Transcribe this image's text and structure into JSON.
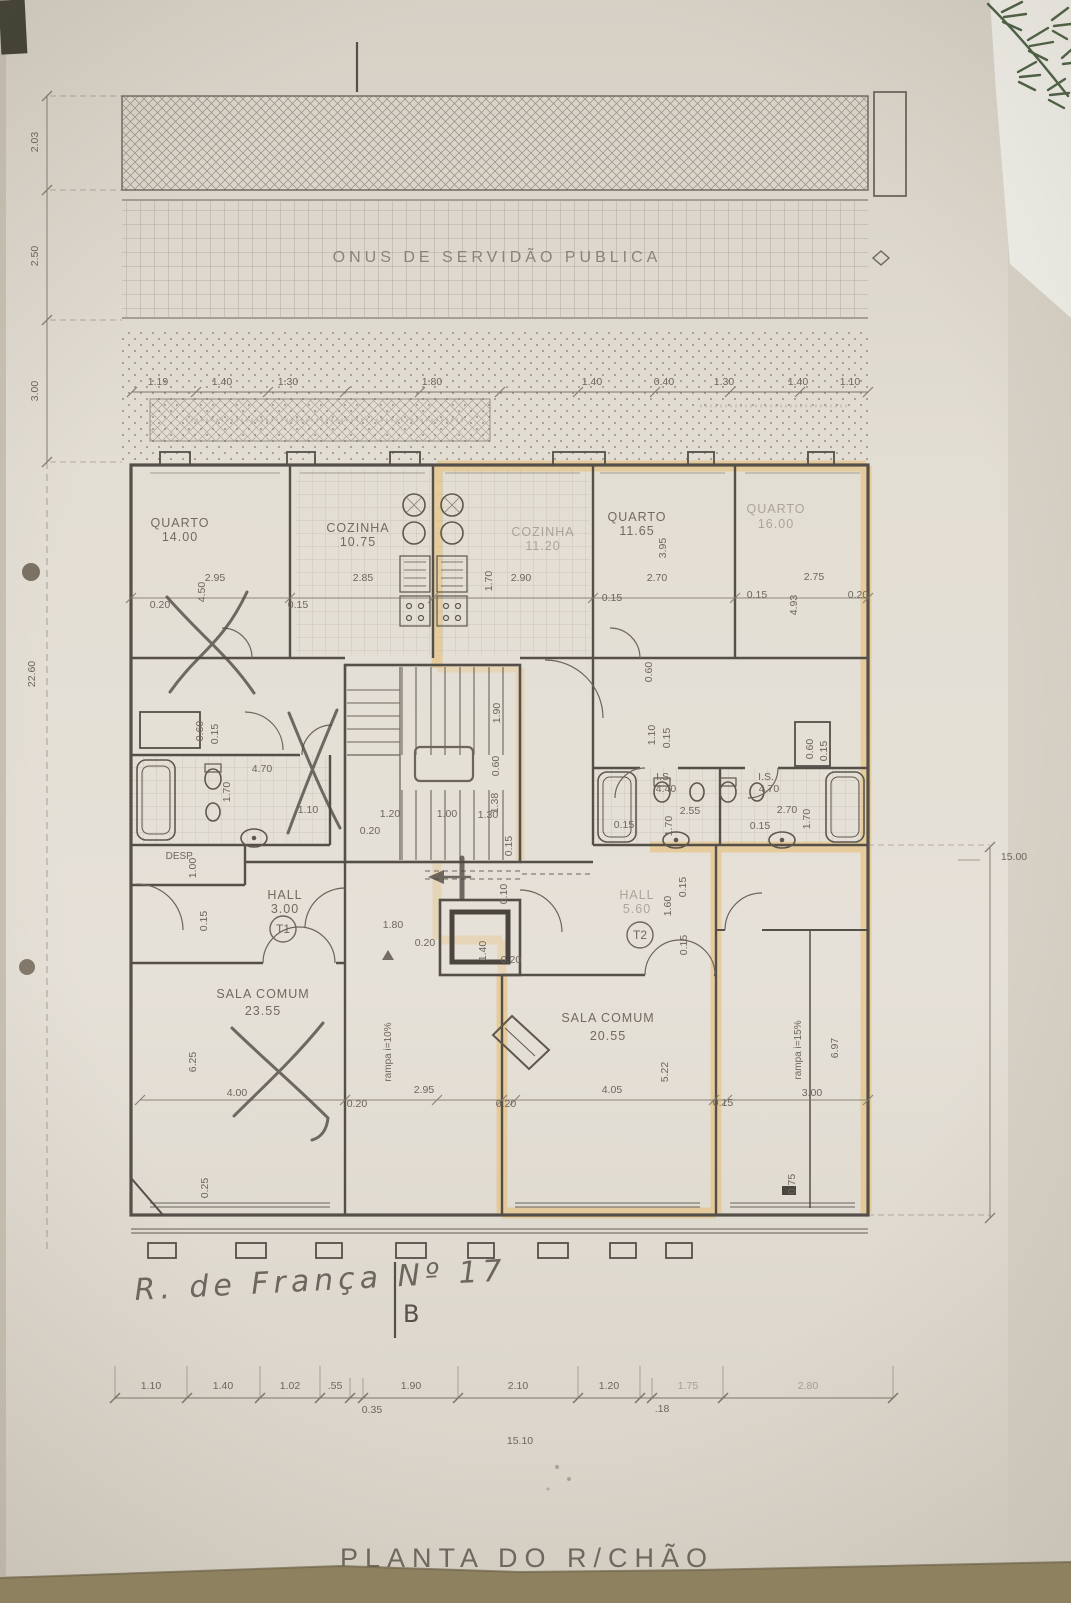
{
  "title": "PLANTA DO R/CHÃO",
  "servitude_label": "ONUS DE SERVIDÃO PUBLICA",
  "street_note": "R. de França Nº 17",
  "section_marker": "B",
  "unit_markers": {
    "t1": "T1",
    "t2": "T2"
  },
  "labels": [
    {
      "t": "QUARTO",
      "x": 180,
      "y": 527,
      "c": "room"
    },
    {
      "t": "14.00",
      "x": 180,
      "y": 541,
      "c": "room"
    },
    {
      "t": "COZINHA",
      "x": 358,
      "y": 532,
      "c": "room"
    },
    {
      "t": "10.75",
      "x": 358,
      "y": 546,
      "c": "room"
    },
    {
      "t": "COZINHA",
      "x": 543,
      "y": 536,
      "c": "room faintr"
    },
    {
      "t": "11.20",
      "x": 543,
      "y": 550,
      "c": "room faintr"
    },
    {
      "t": "QUARTO",
      "x": 637,
      "y": 521,
      "c": "room"
    },
    {
      "t": "11.65",
      "x": 637,
      "y": 535,
      "c": "room"
    },
    {
      "t": "QUARTO",
      "x": 776,
      "y": 513,
      "c": "room faintr"
    },
    {
      "t": "16.00",
      "x": 776,
      "y": 528,
      "c": "room faintr"
    },
    {
      "t": "SALA COMUM",
      "x": 263,
      "y": 998,
      "c": "room"
    },
    {
      "t": "23.55",
      "x": 263,
      "y": 1015,
      "c": "room"
    },
    {
      "t": "SALA COMUM",
      "x": 608,
      "y": 1022,
      "c": "room"
    },
    {
      "t": "20.55",
      "x": 608,
      "y": 1040,
      "c": "room"
    },
    {
      "t": "HALL",
      "x": 285,
      "y": 899,
      "c": "room"
    },
    {
      "t": "3.00",
      "x": 285,
      "y": 913,
      "c": "room"
    },
    {
      "t": "HALL",
      "x": 637,
      "y": 899,
      "c": "room faintr"
    },
    {
      "t": "5.60",
      "x": 637,
      "y": 913,
      "c": "room faintr"
    },
    {
      "t": "DESP.",
      "x": 180,
      "y": 859,
      "c": "small"
    },
    {
      "t": "I.S.",
      "x": 664,
      "y": 780
    },
    {
      "t": "4.40",
      "x": 666,
      "y": 792
    },
    {
      "t": "I.S.",
      "x": 766,
      "y": 780
    },
    {
      "t": "4.70",
      "x": 769,
      "y": 792
    },
    {
      "t": "rampa  i=10%",
      "x": 391,
      "y": 1052,
      "r": -90,
      "c": "small"
    },
    {
      "t": "rampa  i=15%",
      "x": 801,
      "y": 1050,
      "r": -90,
      "c": "small"
    },
    {
      "t": "2.95",
      "x": 215,
      "y": 581
    },
    {
      "t": "0.20",
      "x": 160,
      "y": 608
    },
    {
      "t": "4.50",
      "x": 205,
      "y": 592,
      "r": -90
    },
    {
      "t": "0.15",
      "x": 298,
      "y": 608
    },
    {
      "t": "2.85",
      "x": 363,
      "y": 581
    },
    {
      "t": "1.70",
      "x": 492,
      "y": 581,
      "r": -90
    },
    {
      "t": "2.90",
      "x": 521,
      "y": 581
    },
    {
      "t": "0.15",
      "x": 612,
      "y": 601
    },
    {
      "t": "3.95",
      "x": 666,
      "y": 548,
      "r": -90
    },
    {
      "t": "2.70",
      "x": 657,
      "y": 581
    },
    {
      "t": "0.15",
      "x": 757,
      "y": 598
    },
    {
      "t": "2.75",
      "x": 814,
      "y": 580
    },
    {
      "t": "0.20",
      "x": 858,
      "y": 598
    },
    {
      "t": "4.93",
      "x": 797,
      "y": 605,
      "r": -90
    },
    {
      "t": "0.60",
      "x": 652,
      "y": 672,
      "r": -90
    },
    {
      "t": "1.10",
      "x": 655,
      "y": 735,
      "r": -90
    },
    {
      "t": "0.15",
      "x": 670,
      "y": 738,
      "r": -90
    },
    {
      "t": "0.60",
      "x": 203,
      "y": 731,
      "r": -90
    },
    {
      "t": "0.15",
      "x": 218,
      "y": 734,
      "r": -90
    },
    {
      "t": "4.70",
      "x": 262,
      "y": 772
    },
    {
      "t": "1.70",
      "x": 230,
      "y": 792,
      "r": -90
    },
    {
      "t": "1.10",
      "x": 308,
      "y": 813
    },
    {
      "t": "1.00",
      "x": 196,
      "y": 868,
      "r": -90
    },
    {
      "t": "0.15",
      "x": 207,
      "y": 921,
      "r": -90
    },
    {
      "t": "1.90",
      "x": 500,
      "y": 713,
      "r": -90
    },
    {
      "t": "0.60",
      "x": 499,
      "y": 766,
      "r": -90
    },
    {
      "t": "1.38",
      "x": 498,
      "y": 803,
      "r": -90
    },
    {
      "t": "0.15",
      "x": 512,
      "y": 846,
      "r": -90
    },
    {
      "t": "1.20",
      "x": 390,
      "y": 817
    },
    {
      "t": "1.00",
      "x": 447,
      "y": 817
    },
    {
      "t": "1.30",
      "x": 488,
      "y": 818
    },
    {
      "t": "0.20",
      "x": 370,
      "y": 834
    },
    {
      "t": "2.55",
      "x": 690,
      "y": 814
    },
    {
      "t": "1.70",
      "x": 672,
      "y": 826,
      "r": -90
    },
    {
      "t": "0.15",
      "x": 624,
      "y": 828
    },
    {
      "t": "2.70",
      "x": 787,
      "y": 813
    },
    {
      "t": "1.70",
      "x": 810,
      "y": 819,
      "r": -90
    },
    {
      "t": "0.15",
      "x": 760,
      "y": 829
    },
    {
      "t": "0.60",
      "x": 813,
      "y": 749,
      "r": -90
    },
    {
      "t": "0.15",
      "x": 827,
      "y": 751,
      "r": -90
    },
    {
      "t": "1.80",
      "x": 393,
      "y": 928
    },
    {
      "t": "0.20",
      "x": 425,
      "y": 946
    },
    {
      "t": "1.40",
      "x": 486,
      "y": 951,
      "r": -90
    },
    {
      "t": "0.20",
      "x": 511,
      "y": 963
    },
    {
      "t": "0.10",
      "x": 507,
      "y": 894,
      "r": -90
    },
    {
      "t": "1.60",
      "x": 671,
      "y": 906,
      "r": -90
    },
    {
      "t": "0.15",
      "x": 686,
      "y": 887,
      "r": -90
    },
    {
      "t": "0.15",
      "x": 687,
      "y": 945,
      "r": -90
    },
    {
      "t": "6.25",
      "x": 196,
      "y": 1062,
      "r": -90
    },
    {
      "t": "4.00",
      "x": 237,
      "y": 1096
    },
    {
      "t": "0.25",
      "x": 208,
      "y": 1188,
      "r": -90
    },
    {
      "t": "0.20",
      "x": 357,
      "y": 1107
    },
    {
      "t": "2.95",
      "x": 424,
      "y": 1093
    },
    {
      "t": "0.20",
      "x": 506,
      "y": 1107
    },
    {
      "t": "4.05",
      "x": 612,
      "y": 1093
    },
    {
      "t": "5.22",
      "x": 668,
      "y": 1072,
      "r": -90
    },
    {
      "t": "0.15",
      "x": 723,
      "y": 1106
    },
    {
      "t": "3.00",
      "x": 812,
      "y": 1096
    },
    {
      "t": "6.97",
      "x": 838,
      "y": 1048,
      "r": -90
    },
    {
      "t": "0.75",
      "x": 795,
      "y": 1184,
      "r": -90
    },
    {
      "t": "2.03",
      "x": 38,
      "y": 142,
      "r": -90
    },
    {
      "t": "2.50",
      "x": 38,
      "y": 256,
      "r": -90
    },
    {
      "t": "3.00",
      "x": 38,
      "y": 391,
      "r": -90
    },
    {
      "t": "22.60",
      "x": 35,
      "y": 674,
      "r": -90
    },
    {
      "t": "15.00",
      "x": 1014,
      "y": 860
    },
    {
      "t": "1.19",
      "x": 158,
      "y": 385
    },
    {
      "t": "1.40",
      "x": 222,
      "y": 385
    },
    {
      "t": "1.30",
      "x": 288,
      "y": 385
    },
    {
      "t": "1.80",
      "x": 432,
      "y": 385
    },
    {
      "t": "1.40",
      "x": 592,
      "y": 385
    },
    {
      "t": "0.40",
      "x": 664,
      "y": 385
    },
    {
      "t": "1.30",
      "x": 724,
      "y": 385
    },
    {
      "t": "1.40",
      "x": 798,
      "y": 385
    },
    {
      "t": "1.10",
      "x": 850,
      "y": 385
    },
    {
      "t": "1.10",
      "x": 151,
      "y": 1389
    },
    {
      "t": "1.40",
      "x": 223,
      "y": 1389
    },
    {
      "t": "1.02",
      "x": 290,
      "y": 1389
    },
    {
      "t": ".55",
      "x": 335,
      "y": 1389
    },
    {
      "t": "1.90",
      "x": 411,
      "y": 1389
    },
    {
      "t": "2.10",
      "x": 518,
      "y": 1389
    },
    {
      "t": "1.20",
      "x": 609,
      "y": 1389
    },
    {
      "t": "1.75",
      "x": 688,
      "y": 1389,
      "c": "dim faintr"
    },
    {
      "t": "2.80",
      "x": 808,
      "y": 1389,
      "c": "dim faintr"
    },
    {
      "t": "0.35",
      "x": 372,
      "y": 1413
    },
    {
      "t": ".18",
      "x": 662,
      "y": 1412
    },
    {
      "t": "15.10",
      "x": 520,
      "y": 1444
    }
  ]
}
